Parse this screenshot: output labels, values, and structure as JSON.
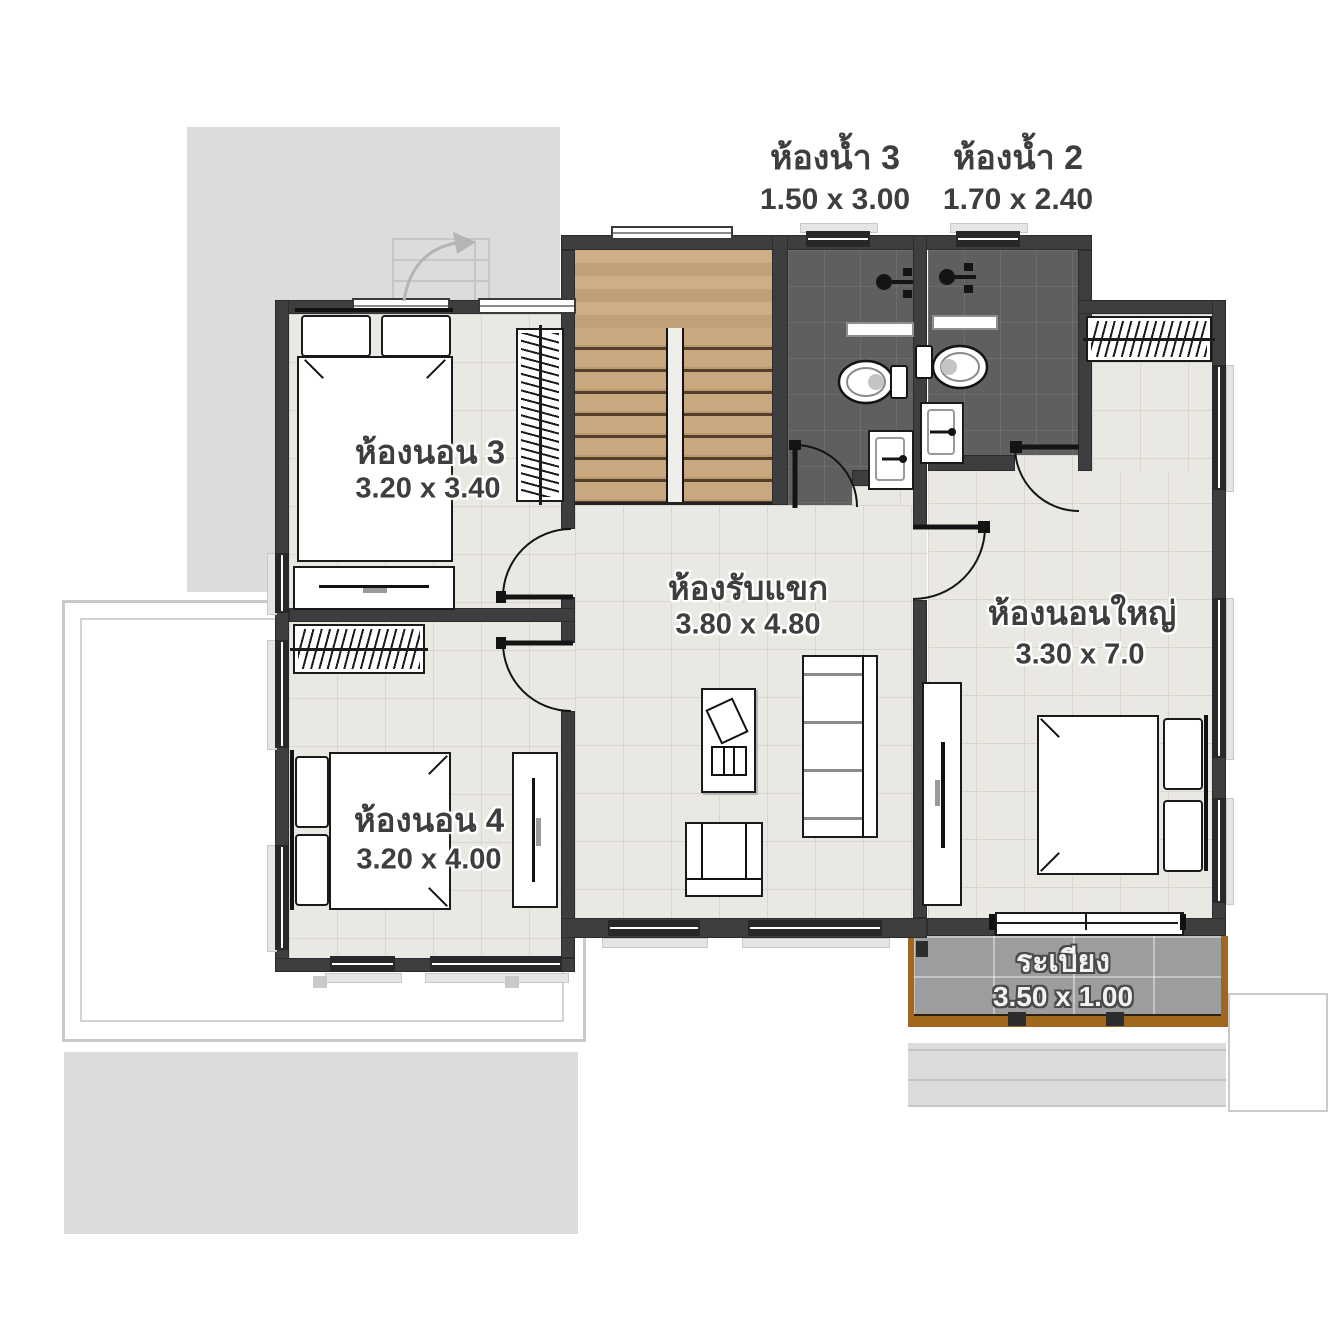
{
  "plan": {
    "rooms": [
      {
        "name": "ห้องน้ำ 3",
        "dims": "1.50 x 3.00"
      },
      {
        "name": "ห้องน้ำ 2",
        "dims": "1.70 x 2.40"
      },
      {
        "name": "ห้องนอน 3",
        "dims": "3.20 x 3.40"
      },
      {
        "name": "ห้องรับแขก",
        "dims": "3.80 x 4.80"
      },
      {
        "name": "ห้องนอนใหญ่",
        "dims": "3.30 x 7.0"
      },
      {
        "name": "ห้องนอน 4",
        "dims": "3.20 x 4.00"
      },
      {
        "name": "ระเบียง",
        "dims": "3.50 x 1.00"
      }
    ],
    "colors": {
      "wall": "#3d3e40",
      "floor_tile": "#eae8e2",
      "bath_tile": "#5d5f61",
      "stair_wood": "#c9a87f",
      "roof": "#dbdcdc",
      "balcony": "#9c9d9e",
      "balcony_wood_edge": "#a2671f"
    }
  }
}
